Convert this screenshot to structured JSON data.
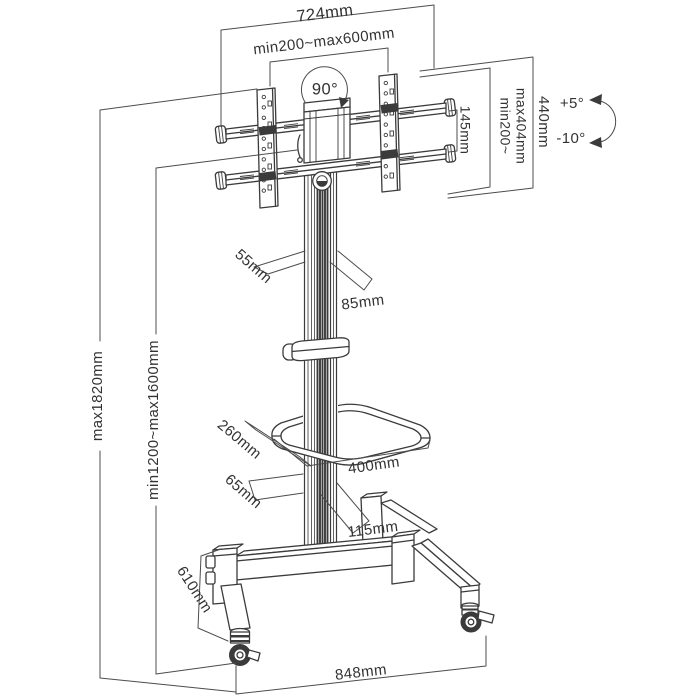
{
  "colors": {
    "background": "#ffffff",
    "structure_line": "#3b3b3b",
    "dimension_line": "#4c4c4c",
    "text": "#333333"
  },
  "labels": {
    "top_width": "724mm",
    "vesa_width_range": "min200~max600mm",
    "swivel_angle": "90°",
    "crossbar_spacing": "145mm",
    "vesa_height_min": "min200~",
    "vesa_height_max": "max404mm",
    "bracket_height": "440mm",
    "tilt_up": "+5°",
    "tilt_down": "-10°",
    "column_front_width": "55mm",
    "column_side_depth": "85mm",
    "max_height": "max1820mm",
    "tv_height_range": "min1200~max1600mm",
    "shelf_depth": "260mm",
    "shelf_width": "400mm",
    "lower_column_width": "65mm",
    "lower_column_depth": "115mm",
    "base_leg_depth": "610mm",
    "base_width": "848mm"
  }
}
